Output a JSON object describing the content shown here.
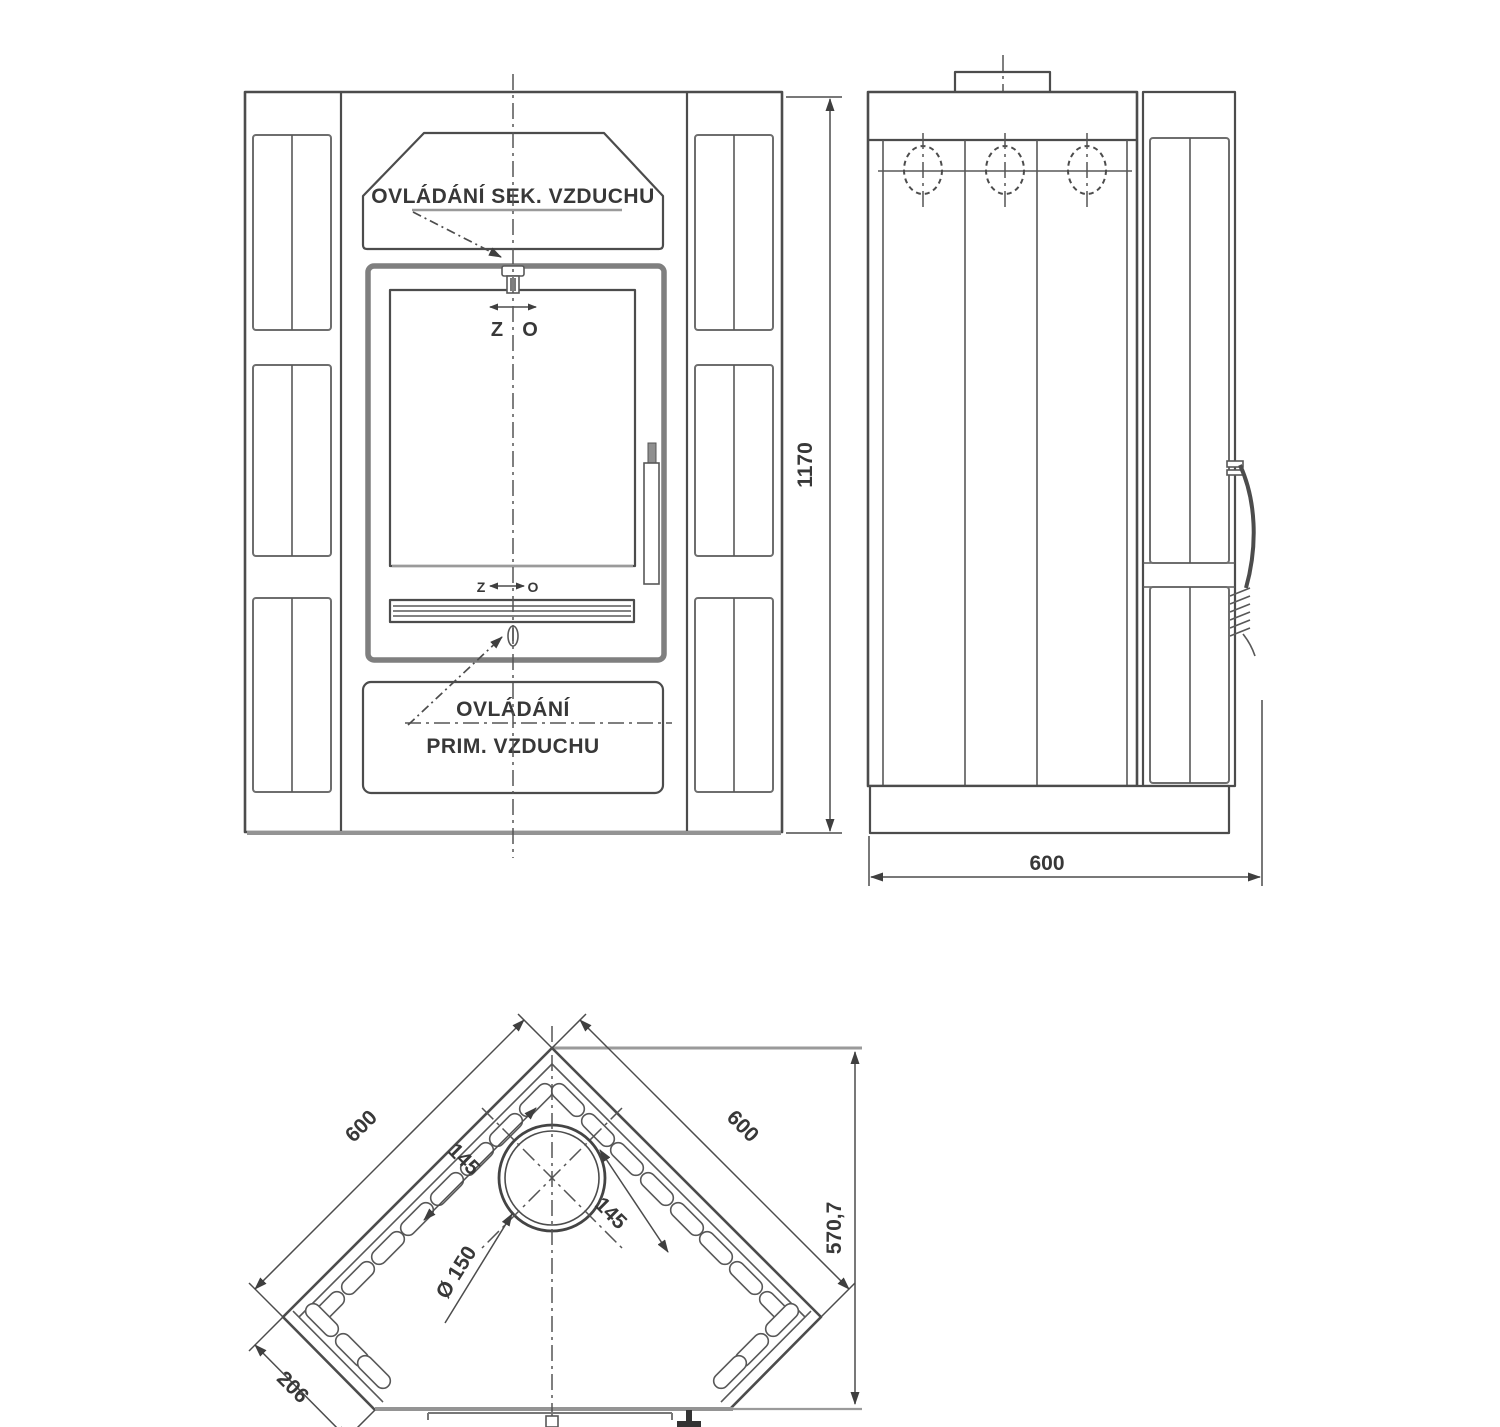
{
  "colors": {
    "line": "#4c4c4c",
    "line_light": "#949494",
    "text": "#383838"
  },
  "front": {
    "secondary_air_label": "OVLÁDÁNÍ SEK. VZDUCHU",
    "primary_air_label_line1": "OVLÁDÁNÍ",
    "primary_air_label_line2": "PRIM. VZDUCHU",
    "damper_top": {
      "closed": "Z",
      "open": "O"
    },
    "damper_bottom": {
      "closed": "Z",
      "open": "O"
    },
    "height_dim": "1170"
  },
  "side": {
    "depth_dim": "600"
  },
  "top": {
    "back_left_dim": "600",
    "back_right_dim": "600",
    "front_depth_dim": "570,7",
    "flue_offset_left": "145",
    "flue_offset_right": "145",
    "flue_diameter": "Ø 150",
    "corner_cut_dim": "206"
  }
}
